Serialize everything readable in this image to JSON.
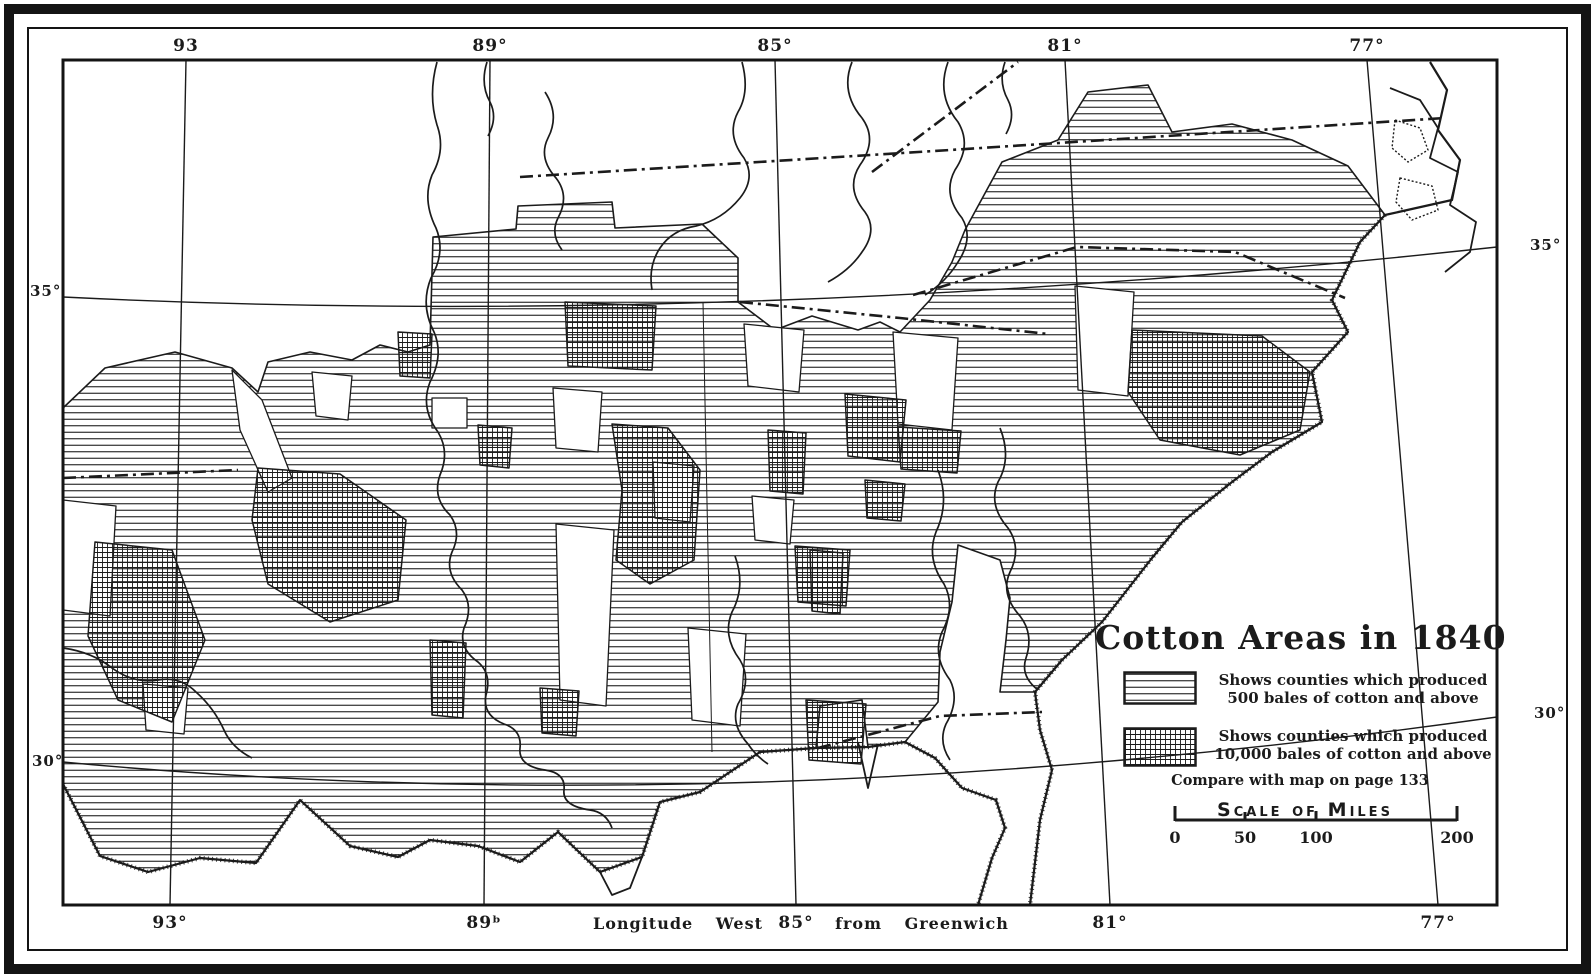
{
  "map": {
    "title": "Cotton Areas in 1840",
    "legend": {
      "items": [
        {
          "swatch": "hatch-horizontal-swatch-icon",
          "line1": "Shows counties which produced",
          "line2": "500 bales of cotton and above"
        },
        {
          "swatch": "hatch-grid-swatch-icon",
          "line1": "Shows counties which produced",
          "line2": "10,000 bales of cotton and above"
        }
      ],
      "note": "Compare with map on page 133"
    },
    "scale": {
      "heading": "Scale of Miles",
      "ticks": [
        "0",
        "50",
        "100",
        "200"
      ]
    },
    "graticule": {
      "top": [
        "93",
        "89°",
        "85°",
        "81°",
        "77°"
      ],
      "bottom": [
        "93°",
        "89ᵇ",
        "85°",
        "81°",
        "77°"
      ],
      "left": [
        "35°",
        "30°"
      ],
      "right": [
        "35°",
        "30°"
      ],
      "bottom_caption_left": "Longitude  West",
      "bottom_caption_right": "from  Greenwich"
    },
    "colors": {
      "ink": "#1b1b1b",
      "paper": "#ffffff"
    }
  }
}
